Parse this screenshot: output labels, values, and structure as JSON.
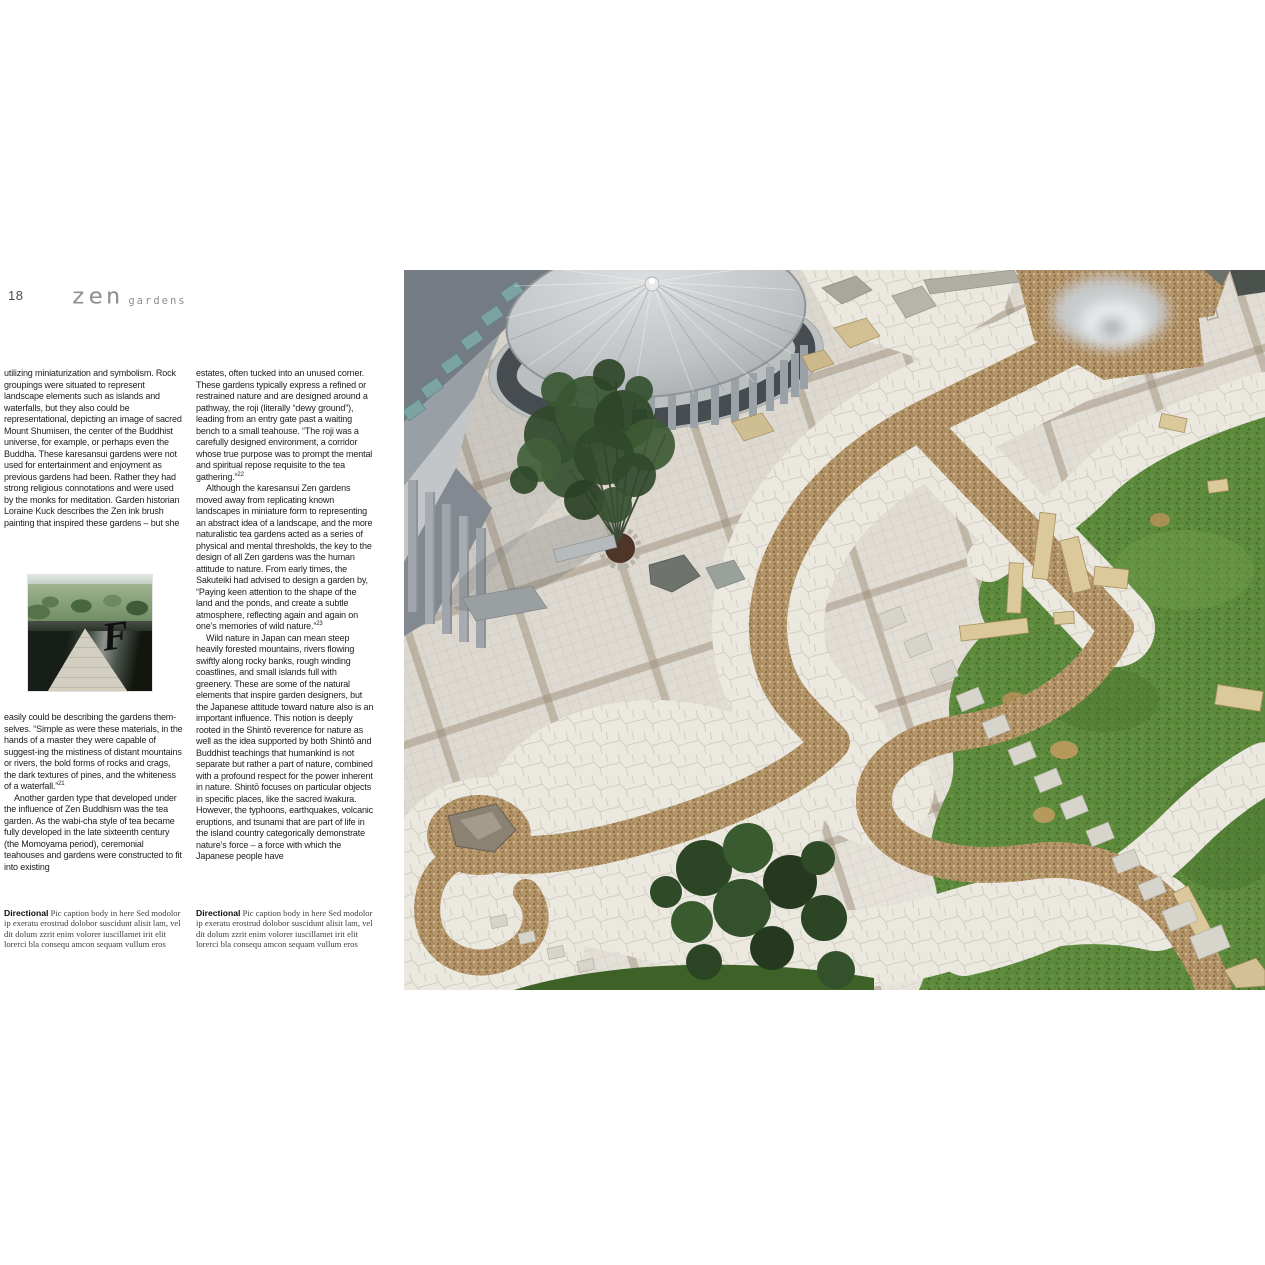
{
  "page": {
    "number": "18",
    "header_title": "zen",
    "header_subtitle": "gardens"
  },
  "columns": {
    "col1": {
      "p1": "utilizing miniaturization and symbolism.  Rock groupings were situated to represent landscape elements such as islands and waterfalls, but they also could be representational, depicting an image of sacred Mount Shumisen, the center of the Buddhist universe, for example, or perhaps even the Buddha.  These karesansui gardens were not used for entertainment and enjoyment as previous gardens had been.  Rather they had strong religious connotations and were used by the monks for meditation.   Garden historian Loraine Kuck describes the Zen ink brush painting that inspired these gardens – but she",
      "p2": "easily could be describing the gardens them-selves.  “Simple as were these materials, in the hands of a master they were capable of suggest-ing the mistiness of distant mountains or rivers, the bold forms of rocks and crags, the dark textures of pines, and the whiteness of a waterfall.”",
      "p2_sup": "21",
      "p3": "Another garden type that developed under the influence of Zen Buddhism was the tea garden.  As the wabi-cha style of tea became fully developed in the late sixteenth century (the Momoyama period), ceremonial teahouses and gardens were constructed to fit into existing"
    },
    "col2": {
      "p1": "estates, often tucked into an unused corner.  These gardens typically express a refined or restrained nature and are designed around a pathway, the roji (literally “dewy ground”), leading from an entry gate past a waiting bench to a small teahouse.  “The roji was a carefully designed environment, a corridor whose true purpose was to prompt the mental and spiritual repose requisite to the tea gathering.”",
      "p1_sup": "22",
      "p2": "Although the karesansui Zen gardens moved away from replicating known landscapes in miniature form to representing an abstract idea of a landscape, and the more naturalistic tea gardens acted as a series of physical and mental thresholds, the key to the design of all Zen gardens was the human attitude to nature.  From early times, the Sakuteiki had advised to design a garden by, “Paying keen attention to the shape of the land and the ponds, and create a subtle atmosphere, reflecting again and again on one’s memories of wild nature.”",
      "p2_sup": "23",
      "p3": "Wild nature in Japan can mean steep heavily forested mountains, rivers flowing swiftly along rocky banks, rough winding coastlines, and small islands full with greenery.  These are some of the natural elements that inspire garden designers, but the Japanese attitude toward nature also is an important influence.  This notion is deeply rooted in the Shintō reverence for nature as well as the idea supported by both Shintō and Buddhist teachings that humankind is not separate but rather a part of nature, combined with a profound respect for the power inherent in nature.  Shintō focuses on particular objects in specific places, like the sacred iwakura.  However, the typhoons, earthquakes, volcanic eruptions, and tsunami that are part of life in the island country categorically demonstrate nature’s force – a force with which the Japanese people have"
    }
  },
  "caption": {
    "lead": "Directional",
    "body": " Pic caption body in here Sed modolor ip exeratu erostrud dolobor suscidunt alisit lam, vel dit dolum zzrit enim volorer iuscillamet irit elit lorerci bla consequ amcon sequam vullum eros"
  },
  "photos": {
    "inset_alt": "Stone pyramid walkway over a reflecting pool with trees beyond and a calligraphic mark",
    "main_alt": "Aerial view of a modern Zen courtyard garden: circular pavilion, tiled plaza, winding gravel stream edged with white flagstone, lawn, standing stones and stepping-stone paths",
    "inset_glyph": "F"
  },
  "colors": {
    "grass": "#5d8a3c",
    "gravel": "#b29267",
    "paving": "#ddd8cf",
    "flagstone": "#ebe8e0",
    "stone_tan": "#dbc99b",
    "header_gray": "#8f8f8f"
  }
}
